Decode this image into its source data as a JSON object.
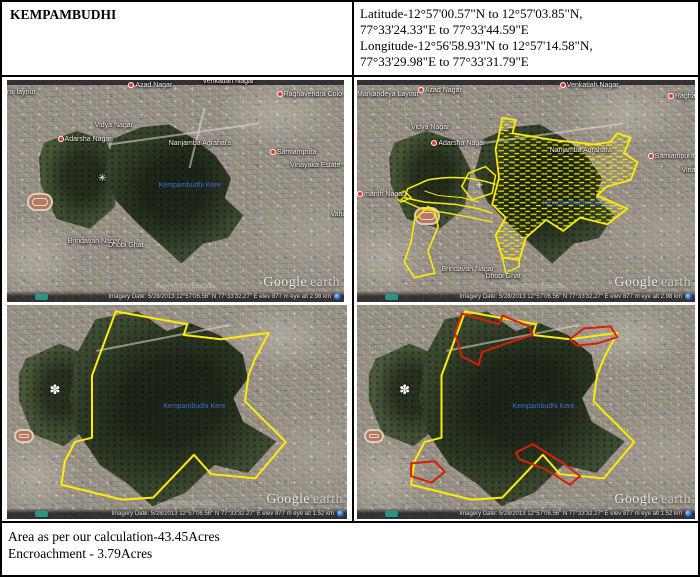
{
  "header": {
    "title": "KEMPAMBUDHI",
    "coord_lines": [
      "Latitude-12°57'00.57\"N to 12°57'03.85\"N,",
      "77°33'24.33\"E to 77°33'44.59\"E",
      "Longitude-12°56'58.93\"N to 12°57'14.58\"N,",
      "77°33'29.98\"E to 77°33'31.79\"E"
    ]
  },
  "footer": {
    "area_line": "Area as per our calculation-43.45Acres",
    "encroachment_line": "Encroachment - 3.79Acres"
  },
  "lake_label": "Kempambudhi Kere",
  "watermark": {
    "google": "Google",
    "earth": "earth"
  },
  "status_bar": {
    "top": "Imagery Date: 5/28/2013    12°57'06.56\" N   77°33'32.27\" E   elev  877 m    eye alt  2.98 km",
    "bottom": "Imagery Date: 5/28/2013    12°57'06.56\" N   77°33'32.27\" E   elev  877 m    eye alt  1.52 km"
  },
  "copyright": "Image © 2016 DigitalGlobe",
  "panels": {
    "tl": {
      "labels": [
        {
          "text": "raj layout"
        },
        {
          "text": "Azad Nagar"
        },
        {
          "text": "Venkatiah Nagar"
        },
        {
          "text": "Raghavendra Colo"
        },
        {
          "text": "Vidya Nagar"
        },
        {
          "text": "Adarsha Nagar"
        },
        {
          "text": "Nanjamba Agrahara"
        },
        {
          "text": "Samiampura"
        },
        {
          "text": "Vinayaka Estate"
        },
        {
          "text": "Vaha"
        },
        {
          "text": "Brindavan Nagar"
        },
        {
          "text": "Dhobi Ghat"
        }
      ]
    },
    "tr": {
      "labels": [
        {
          "text": "Markandeya Layout"
        },
        {
          "text": "Azad Nagar"
        },
        {
          "text": "Venkatiah Nagar"
        },
        {
          "text": "Raghaven"
        },
        {
          "text": "Vidya Nagar"
        },
        {
          "text": "Adarsha Nagar"
        },
        {
          "text": "Nanjamba Agrahara"
        },
        {
          "text": "Samiampura"
        },
        {
          "text": "Vinaya"
        },
        {
          "text": "manth Nagar"
        },
        {
          "text": "Brindavan Nagar"
        },
        {
          "text": "Dhobi Ghat"
        }
      ]
    }
  },
  "overlays": {
    "boundary_color": "#ffec00",
    "encroachment_color": "#d42105",
    "lake_label_blue": "#3b6ed6",
    "hatch_style": "yellow dashed grid fill over lake area"
  }
}
